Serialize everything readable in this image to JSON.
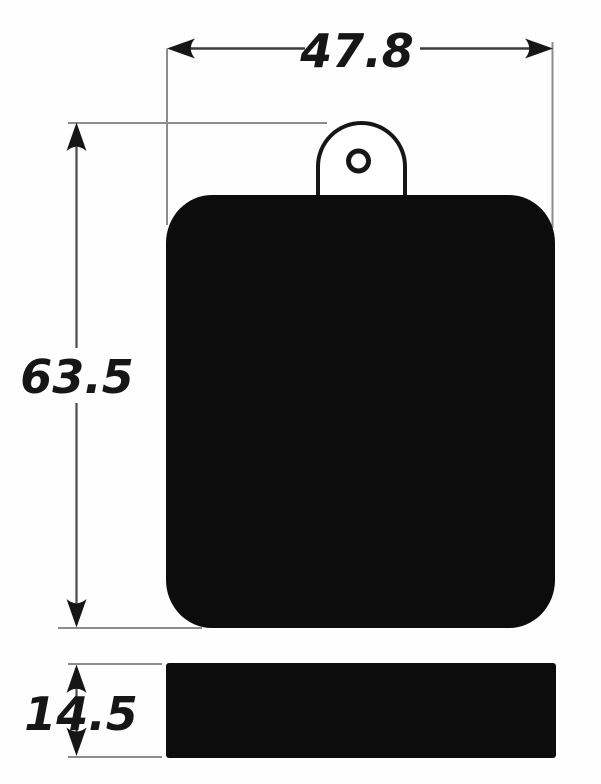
{
  "drawing": {
    "dimensions": {
      "width": "47.8",
      "height": "63.5",
      "thickness": "14.5"
    },
    "colors": {
      "part_fill": "#0c0c0c",
      "outline": "#161616",
      "dimension_line": "#3d3d3d",
      "extension_line": "#8c8c8c",
      "label_text": "#161616",
      "background": "#fefefe"
    }
  }
}
